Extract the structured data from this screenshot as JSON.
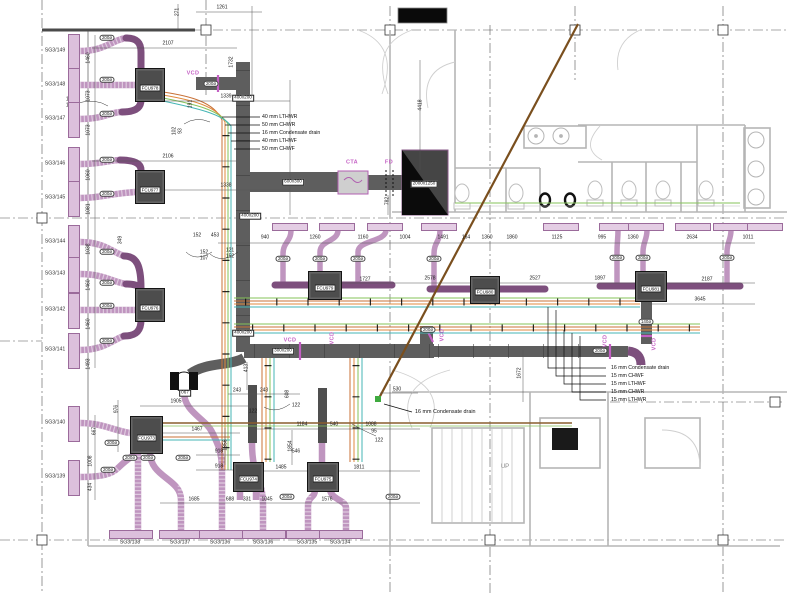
{
  "colors": {
    "duct_gray": "#5e5e5e",
    "duct_purple": "#7d4f7d",
    "duct_purple_light": "#bf95bf",
    "magenta": "#c45fc4",
    "pipe_orange": "#c87137",
    "pipe_orange2": "#e08a3c",
    "pipe_green": "#86c35a",
    "pipe_teal": "#45b5b5",
    "drain_brown": "#7a4f1e"
  },
  "legend_top": {
    "items": [
      "40 mm  LTHWR",
      "50 mm  CHWR",
      "16 mm  Condensate drain",
      "40 mm  LTHWF",
      "50 mm  CHWF"
    ]
  },
  "legend_right": {
    "items": [
      "16 mm  Condensate drain",
      "15 mm  CHWF",
      "15 mm  LTHWF",
      "15 mm  CHWR",
      "15 mm  LTHWR"
    ]
  },
  "drain_callout": {
    "text": "16 mm  Condensate drain"
  },
  "up_label": "UP",
  "fan_tag": "067",
  "cta_label": "CTA",
  "fd_label": "FD",
  "vcd_text": "VCD",
  "vcd_labels": [
    {
      "x": 193,
      "y": 74
    },
    {
      "x": 290,
      "y": 341
    },
    {
      "x": 333,
      "y": 338,
      "r": 1
    },
    {
      "x": 443,
      "y": 335,
      "r": 1
    },
    {
      "x": 606,
      "y": 341,
      "r": 1
    },
    {
      "x": 655,
      "y": 344,
      "r": 1
    }
  ],
  "grilles_left": [
    {
      "label": "SG3/149",
      "y": 51
    },
    {
      "label": "SG3/148",
      "y": 85
    },
    {
      "label": "SG3/147",
      "y": 119
    },
    {
      "label": "SG3/146",
      "y": 164
    },
    {
      "label": "SG3/145",
      "y": 198
    },
    {
      "label": "SG3/144",
      "y": 242
    },
    {
      "label": "SG3/143",
      "y": 274
    },
    {
      "label": "SG3/142",
      "y": 310
    },
    {
      "label": "SG3/141",
      "y": 350
    },
    {
      "label": "SG3/140",
      "y": 423
    },
    {
      "label": "SG3/139",
      "y": 477
    }
  ],
  "grilles_bottom": [
    {
      "label": "SG3/138",
      "x": 130
    },
    {
      "label": "SG3/137",
      "x": 180
    },
    {
      "label": "SG3/136",
      "x": 220
    },
    {
      "label": "SG3/136",
      "x": 263
    },
    {
      "label": "SG3/135",
      "x": 307
    },
    {
      "label": "SG3/134",
      "x": 340
    }
  ],
  "fcus": [
    {
      "label": "FCU978",
      "x": 135,
      "y": 68,
      "w": 28,
      "h": 32
    },
    {
      "label": "FCU977",
      "x": 135,
      "y": 170,
      "w": 28,
      "h": 32
    },
    {
      "label": "FCU976",
      "x": 135,
      "y": 288,
      "w": 28,
      "h": 32
    },
    {
      "label": "FCU973",
      "x": 130,
      "y": 416,
      "w": 31,
      "h": 36
    },
    {
      "label": "FCU974",
      "x": 233,
      "y": 462,
      "w": 29,
      "h": 28
    },
    {
      "label": "FCU975",
      "x": 307,
      "y": 462,
      "w": 30,
      "h": 28
    },
    {
      "label": "FCU979",
      "x": 308,
      "y": 271,
      "w": 32,
      "h": 27
    },
    {
      "label": "FCU980",
      "x": 470,
      "y": 276,
      "w": 28,
      "h": 26
    },
    {
      "label": "FCU981",
      "x": 635,
      "y": 271,
      "w": 30,
      "h": 29
    }
  ],
  "diffusers": [
    {
      "x": 289
    },
    {
      "x": 336
    },
    {
      "x": 384
    },
    {
      "x": 438
    },
    {
      "x": 560
    },
    {
      "x": 616
    },
    {
      "x": 645
    },
    {
      "x": 692
    },
    {
      "x": 730
    },
    {
      "x": 764
    }
  ],
  "duct_size_labels": [
    {
      "t": "400x200",
      "x": 243,
      "y": 98
    },
    {
      "t": "400x200",
      "x": 250,
      "y": 216
    },
    {
      "t": "400x200",
      "x": 243,
      "y": 333
    },
    {
      "t": "600x300",
      "x": 293,
      "y": 182
    },
    {
      "t": "300x200",
      "x": 283,
      "y": 351
    },
    {
      "t": "2000x1250",
      "x": 424,
      "y": 184
    }
  ],
  "round_duct_labels": [
    {
      "x": 107,
      "y": 38
    },
    {
      "x": 107,
      "y": 80
    },
    {
      "x": 107,
      "y": 114
    },
    {
      "x": 107,
      "y": 160
    },
    {
      "x": 107,
      "y": 194
    },
    {
      "x": 107,
      "y": 252
    },
    {
      "x": 107,
      "y": 283
    },
    {
      "x": 107,
      "y": 306
    },
    {
      "x": 107,
      "y": 341
    },
    {
      "x": 112,
      "y": 443
    },
    {
      "x": 108,
      "y": 470
    },
    {
      "x": 211,
      "y": 84
    },
    {
      "x": 283,
      "y": 259
    },
    {
      "x": 320,
      "y": 259
    },
    {
      "x": 358,
      "y": 259
    },
    {
      "x": 434,
      "y": 259
    },
    {
      "x": 617,
      "y": 258
    },
    {
      "x": 643,
      "y": 258
    },
    {
      "x": 727,
      "y": 258
    },
    {
      "x": 428,
      "y": 330
    },
    {
      "x": 600,
      "y": 351
    },
    {
      "t": "140ø",
      "x": 646,
      "y": 322
    },
    {
      "x": 130,
      "y": 458
    },
    {
      "x": 148,
      "y": 458
    },
    {
      "x": 183,
      "y": 458
    },
    {
      "x": 287,
      "y": 497
    },
    {
      "x": 393,
      "y": 497
    }
  ],
  "dims": [
    {
      "t": "271",
      "x": 178,
      "y": 12,
      "r": 1
    },
    {
      "t": "1261",
      "x": 222,
      "y": 8
    },
    {
      "t": "2107",
      "x": 168,
      "y": 44
    },
    {
      "t": "1732",
      "x": 232,
      "y": 62,
      "r": 1
    },
    {
      "t": "1339",
      "x": 226,
      "y": 97
    },
    {
      "t": "2106",
      "x": 168,
      "y": 157
    },
    {
      "t": "1338",
      "x": 226,
      "y": 186
    },
    {
      "t": "4418",
      "x": 421,
      "y": 105,
      "r": 1
    },
    {
      "t": "782",
      "x": 388,
      "y": 201,
      "r": 1
    },
    {
      "t": "1460",
      "x": 89,
      "y": 58,
      "r": 1
    },
    {
      "t": "1073",
      "x": 89,
      "y": 96,
      "r": 1
    },
    {
      "t": "1073",
      "x": 89,
      "y": 130,
      "r": 1
    },
    {
      "t": "1060",
      "x": 89,
      "y": 175,
      "r": 1
    },
    {
      "t": "1081",
      "x": 89,
      "y": 209,
      "r": 1
    },
    {
      "t": "1038",
      "x": 89,
      "y": 249,
      "r": 1
    },
    {
      "t": "1460",
      "x": 89,
      "y": 285,
      "r": 1
    },
    {
      "t": "1460",
      "x": 89,
      "y": 324,
      "r": 1
    },
    {
      "t": "1493",
      "x": 89,
      "y": 364,
      "r": 1
    },
    {
      "t": "667",
      "x": 95,
      "y": 431,
      "r": 1
    },
    {
      "t": "1008",
      "x": 91,
      "y": 461,
      "r": 1
    },
    {
      "t": "434",
      "x": 91,
      "y": 487,
      "r": 1
    },
    {
      "t": "976",
      "x": 117,
      "y": 409,
      "r": 1
    },
    {
      "t": "121",
      "x": 70,
      "y": 100
    },
    {
      "t": "152",
      "x": 70,
      "y": 106
    },
    {
      "t": "191",
      "x": 191,
      "y": 104,
      "r": 1
    },
    {
      "t": "102",
      "x": 175,
      "y": 131,
      "r": 1
    },
    {
      "t": "93",
      "x": 181,
      "y": 131,
      "r": 1
    },
    {
      "t": "349",
      "x": 121,
      "y": 240,
      "r": 1
    },
    {
      "t": "152",
      "x": 197,
      "y": 236
    },
    {
      "t": "453",
      "x": 215,
      "y": 236
    },
    {
      "t": "152",
      "x": 204,
      "y": 253
    },
    {
      "t": "107",
      "x": 204,
      "y": 259
    },
    {
      "t": "121",
      "x": 230,
      "y": 251
    },
    {
      "t": "152",
      "x": 230,
      "y": 257
    },
    {
      "t": "940",
      "x": 265,
      "y": 238
    },
    {
      "t": "1260",
      "x": 315,
      "y": 238
    },
    {
      "t": "1160",
      "x": 363,
      "y": 238
    },
    {
      "t": "1004",
      "x": 405,
      "y": 238
    },
    {
      "t": "1491",
      "x": 443,
      "y": 238
    },
    {
      "t": "164",
      "x": 466,
      "y": 238
    },
    {
      "t": "1360",
      "x": 487,
      "y": 238
    },
    {
      "t": "1860",
      "x": 512,
      "y": 238
    },
    {
      "t": "1125",
      "x": 557,
      "y": 238
    },
    {
      "t": "995",
      "x": 602,
      "y": 238
    },
    {
      "t": "1360",
      "x": 633,
      "y": 238
    },
    {
      "t": "2634",
      "x": 692,
      "y": 238
    },
    {
      "t": "1011",
      "x": 748,
      "y": 238
    },
    {
      "t": "1727",
      "x": 365,
      "y": 280
    },
    {
      "t": "2578",
      "x": 430,
      "y": 279
    },
    {
      "t": "2527",
      "x": 535,
      "y": 279
    },
    {
      "t": "1897",
      "x": 600,
      "y": 279
    },
    {
      "t": "2187",
      "x": 707,
      "y": 280
    },
    {
      "t": "3645",
      "x": 700,
      "y": 300
    },
    {
      "t": "1672",
      "x": 520,
      "y": 373,
      "r": 1
    },
    {
      "t": "413",
      "x": 247,
      "y": 368,
      "r": 1
    },
    {
      "t": "243",
      "x": 237,
      "y": 391
    },
    {
      "t": "243",
      "x": 264,
      "y": 391
    },
    {
      "t": "608",
      "x": 288,
      "y": 394,
      "r": 1
    },
    {
      "t": "530",
      "x": 397,
      "y": 390
    },
    {
      "t": "122",
      "x": 253,
      "y": 412
    },
    {
      "t": "122",
      "x": 296,
      "y": 406
    },
    {
      "t": "95",
      "x": 374,
      "y": 432
    },
    {
      "t": "122",
      "x": 379,
      "y": 441
    },
    {
      "t": "1088",
      "x": 371,
      "y": 425
    },
    {
      "t": "540",
      "x": 334,
      "y": 425
    },
    {
      "t": "1184",
      "x": 302,
      "y": 425
    },
    {
      "t": "1854",
      "x": 291,
      "y": 446,
      "r": 1
    },
    {
      "t": "1856",
      "x": 226,
      "y": 445,
      "r": 1
    },
    {
      "t": "546",
      "x": 296,
      "y": 452
    },
    {
      "t": "918",
      "x": 219,
      "y": 452
    },
    {
      "t": "918",
      "x": 219,
      "y": 467
    },
    {
      "t": "1467",
      "x": 197,
      "y": 430
    },
    {
      "t": "1485",
      "x": 281,
      "y": 468
    },
    {
      "t": "1811",
      "x": 359,
      "y": 468
    },
    {
      "t": "1905",
      "x": 176,
      "y": 402
    },
    {
      "t": "1685",
      "x": 194,
      "y": 500
    },
    {
      "t": "688",
      "x": 230,
      "y": 500
    },
    {
      "t": "331",
      "x": 247,
      "y": 500
    },
    {
      "t": "1045",
      "x": 267,
      "y": 500
    },
    {
      "t": "1576",
      "x": 327,
      "y": 500
    }
  ]
}
